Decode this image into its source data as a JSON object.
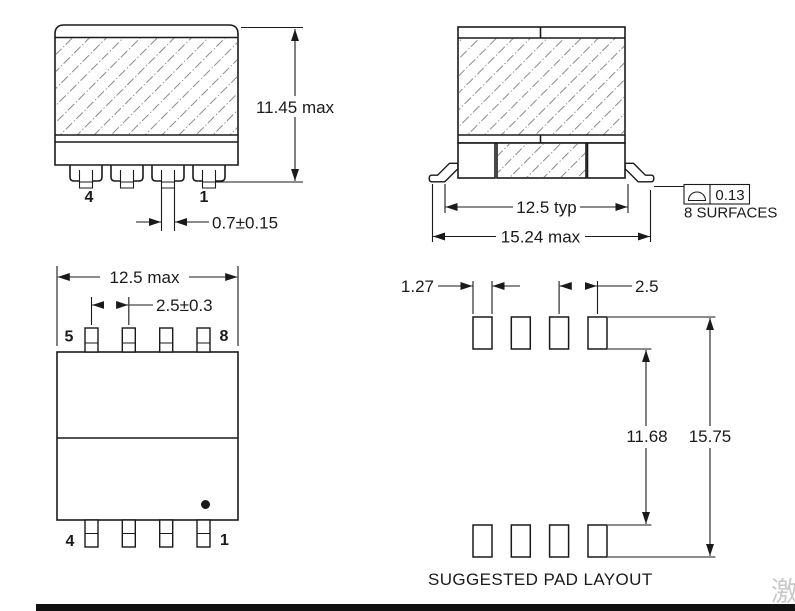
{
  "views": {
    "front": {
      "dim_height": "11.45 max",
      "dim_lead_width": "0.7±0.15",
      "pin_left": "4",
      "pin_right": "1"
    },
    "side": {
      "dim_lead_span": "12.5 typ",
      "dim_overall": "15.24 max",
      "profile_tolerance": "0.13",
      "profile_note": "8 SURFACES"
    },
    "top": {
      "dim_width": "12.5 max",
      "dim_pitch": "2.5±0.3",
      "pin_top_left": "5",
      "pin_top_right": "8",
      "pin_bottom_left": "4",
      "pin_bottom_right": "1"
    },
    "pad_layout": {
      "dim_pad_width": "1.27",
      "dim_pitch": "2.5",
      "dim_span_inner": "11.68",
      "dim_span_outer": "15.75",
      "caption": "SUGGESTED PAD LAYOUT"
    },
    "watermark": "激",
    "colors": {
      "line": "#1a1a1a",
      "hatch": "#8a8a8a",
      "watermark": "#c9c9c9",
      "bottom_bar": "#111111"
    }
  }
}
